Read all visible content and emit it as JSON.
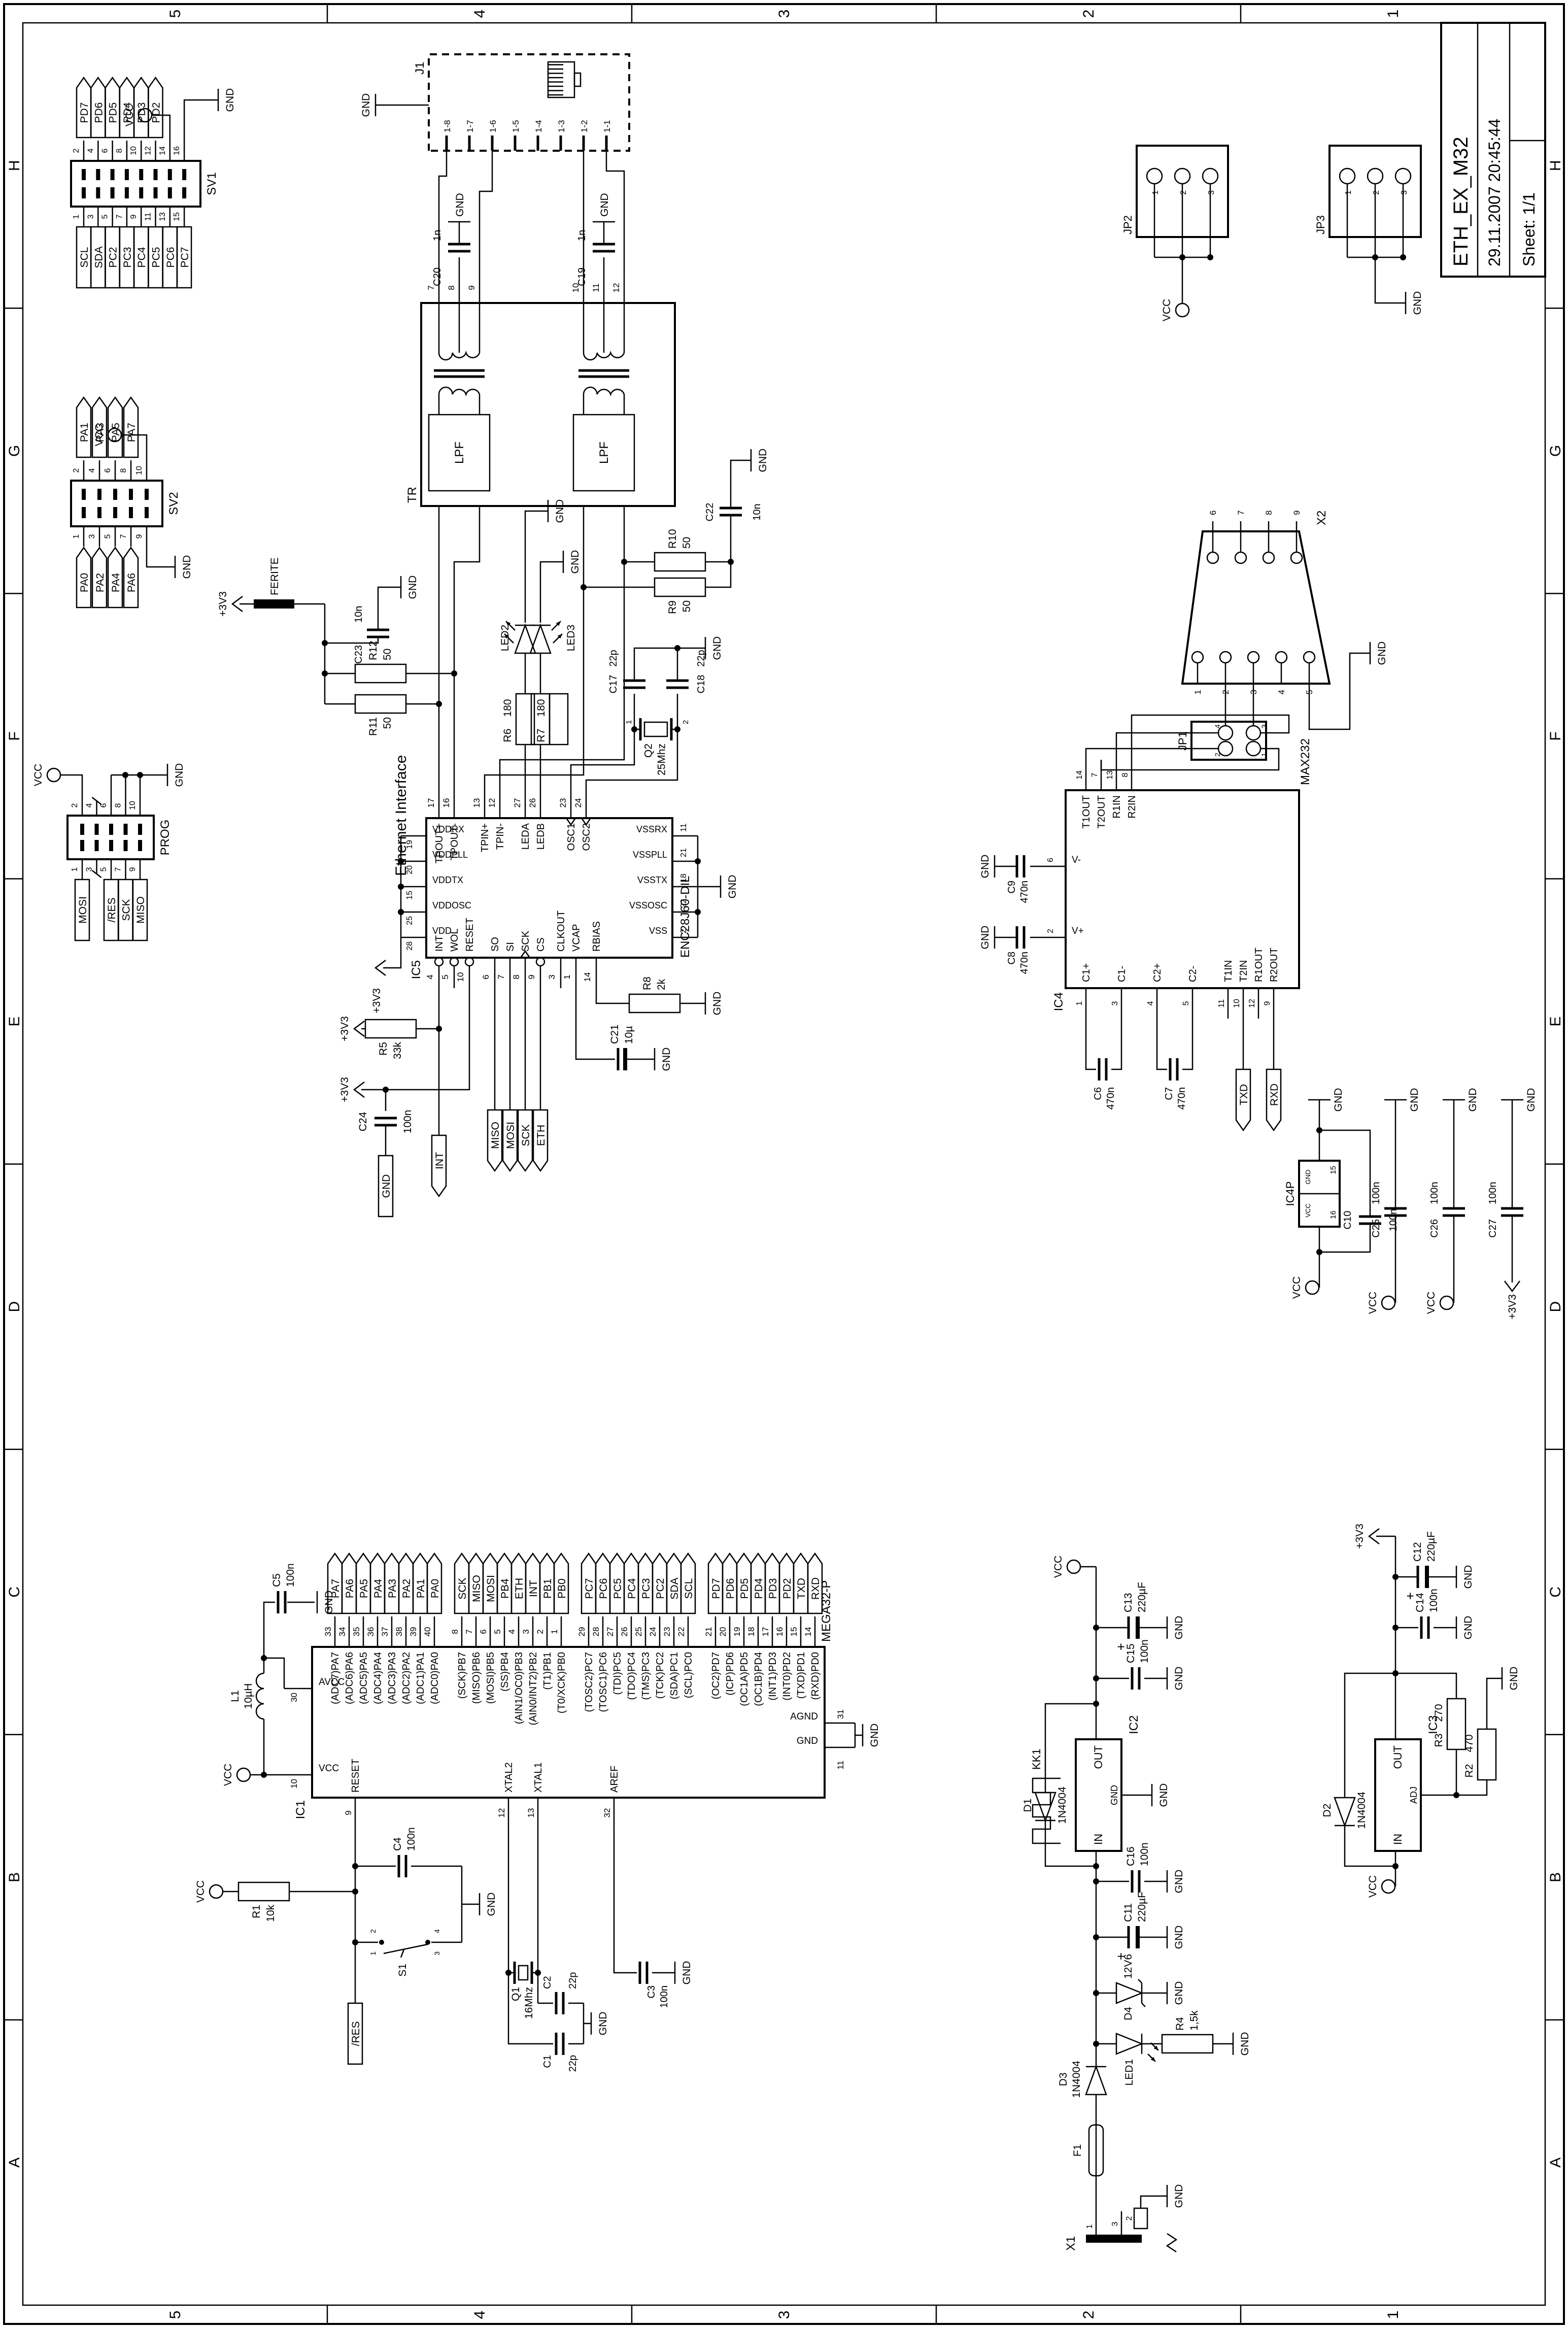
{
  "frame": {
    "columns": [
      "A",
      "B",
      "C",
      "D",
      "E",
      "F",
      "G",
      "H"
    ],
    "rows": [
      "5",
      "4",
      "3",
      "2",
      "1"
    ]
  },
  "title_block": {
    "title": "ETH_EX_M32",
    "datetime": "29.11.2007 20:45:44",
    "sheet": "Sheet: 1/1"
  },
  "sections": {
    "ethernet": "Ethernet Interface"
  },
  "nets": {
    "vcc": "VCC",
    "gnd": "GND",
    "p3v3": "+3V3"
  },
  "flags": {
    "res": "/RES",
    "int": "INT",
    "miso": "MISO",
    "mosi": "MOSI",
    "sck": "SCK",
    "eth": "ETH",
    "txd": "TXD",
    "rxd": "RXD",
    "gnd": "GND"
  },
  "parts": {
    "R1": "10k",
    "R2": "470",
    "R3": "270",
    "R4": "1,5k",
    "R5": "33k",
    "R6": "180",
    "R7": "180",
    "R8": "2k",
    "R9": "50",
    "R10": "50",
    "R11": "50",
    "R12": "50",
    "C1": "22p",
    "C2": "22p",
    "C3": "100n",
    "C4": "100n",
    "C5": "100n",
    "C6": "470n",
    "C7": "470n",
    "C8": "470n",
    "C9": "470n",
    "C10": "100n",
    "C11": "220µF",
    "C12": "220µF",
    "C13": "220µF",
    "C14": "100n",
    "C15": "100n",
    "C16": "100n",
    "C17": "22p",
    "C18": "22p",
    "C19": "1n",
    "C20": "1n",
    "C21": "10µ",
    "C22": "10n",
    "C23": "10n",
    "C24": "100n",
    "C25": "100n",
    "C26": "100n",
    "C27": "100n",
    "L1": "10µH",
    "Q1": "16Mhz",
    "Q2": "25Mhz",
    "D1": "1N4004",
    "D2": "1N4004",
    "D3": "1N4004",
    "D4": "12V6",
    "LED1": "",
    "LED2": "",
    "LED3": "",
    "S1": "",
    "F1": "",
    "X1": "",
    "KK1": "",
    "FERITE": "",
    "TR": ""
  },
  "ic1": {
    "ref": "IC1",
    "part": "MEGA32-P",
    "top": [
      {
        "num": "10",
        "name": "VCC"
      },
      {
        "num": "30",
        "name": "AVCC"
      }
    ],
    "left": [
      {
        "num": "9",
        "name": "RESET"
      },
      {
        "num": "12",
        "name": "XTAL2"
      },
      {
        "num": "13",
        "name": "XTAL1"
      },
      {
        "num": "32",
        "name": "AREF"
      }
    ],
    "bottom": [
      {
        "num": "31",
        "name": "AGND"
      },
      {
        "num": "11",
        "name": "GND"
      }
    ],
    "right_groups": [
      [
        {
          "num": "33",
          "name": "(ADC7)PA7",
          "flag": "PA7"
        },
        {
          "num": "34",
          "name": "(ADC6)PA6",
          "flag": "PA6"
        },
        {
          "num": "35",
          "name": "(ADC5)PA5",
          "flag": "PA5"
        },
        {
          "num": "36",
          "name": "(ADC4)PA4",
          "flag": "PA4"
        },
        {
          "num": "37",
          "name": "(ADC3)PA3",
          "flag": "PA3"
        },
        {
          "num": "38",
          "name": "(ADC2)PA2",
          "flag": "PA2"
        },
        {
          "num": "39",
          "name": "(ADC1)PA1",
          "flag": "PA1"
        },
        {
          "num": "40",
          "name": "(ADC0)PA0",
          "flag": "PA0"
        }
      ],
      [
        {
          "num": "8",
          "name": "(SCK)PB7",
          "flag": "SCK"
        },
        {
          "num": "7",
          "name": "(MISO)PB6",
          "flag": "MISO"
        },
        {
          "num": "6",
          "name": "(MOSI)PB5",
          "flag": "MOSI"
        },
        {
          "num": "5",
          "name": "(SS)PB4",
          "flag": "PB4"
        },
        {
          "num": "4",
          "name": "(AIN1/OC0)PB3",
          "flag": "ETH"
        },
        {
          "num": "3",
          "name": "(AIN0/INT2)PB2",
          "flag": "INT"
        },
        {
          "num": "2",
          "name": "(T1)PB1",
          "flag": "PB1"
        },
        {
          "num": "1",
          "name": "(T0/XCK)PB0",
          "flag": "PB0"
        }
      ],
      [
        {
          "num": "29",
          "name": "(TOSC2)PC7",
          "flag": "PC7"
        },
        {
          "num": "28",
          "name": "(TOSC1)PC6",
          "flag": "PC6"
        },
        {
          "num": "27",
          "name": "(TDI)PC5",
          "flag": "PC5"
        },
        {
          "num": "26",
          "name": "(TDO)PC4",
          "flag": "PC4"
        },
        {
          "num": "25",
          "name": "(TMS)PC3",
          "flag": "PC3"
        },
        {
          "num": "24",
          "name": "(TCK)PC2",
          "flag": "PC2"
        },
        {
          "num": "23",
          "name": "(SDA)PC1",
          "flag": "SDA"
        },
        {
          "num": "22",
          "name": "(SCL)PC0",
          "flag": "SCL"
        }
      ],
      [
        {
          "num": "21",
          "name": "(OC2)PD7",
          "flag": "PD7"
        },
        {
          "num": "20",
          "name": "(ICP)PD6",
          "flag": "PD6"
        },
        {
          "num": "19",
          "name": "(OC1A)PD5",
          "flag": "PD5"
        },
        {
          "num": "18",
          "name": "(OC1B)PD4",
          "flag": "PD4"
        },
        {
          "num": "17",
          "name": "(INT1)PD3",
          "flag": "PD3"
        },
        {
          "num": "16",
          "name": "(INT0)PD2",
          "flag": "PD2"
        },
        {
          "num": "15",
          "name": "(TXD)PD1",
          "flag": "TXD"
        },
        {
          "num": "14",
          "name": "(RXD)PD0",
          "flag": "RXD"
        }
      ]
    ]
  },
  "ic5": {
    "ref": "IC5",
    "part": "ENC28J60-DIL",
    "left": [
      {
        "num": "4",
        "name": "INT",
        "inv": 1
      },
      {
        "num": "5",
        "name": "WOL",
        "inv": 1
      },
      {
        "num": "10",
        "name": "RESET",
        "inv": 1
      },
      {
        "num": "6",
        "name": "SO"
      },
      {
        "num": "7",
        "name": "SI"
      },
      {
        "num": "8",
        "name": "SCK",
        "clk": 1
      },
      {
        "num": "9",
        "name": "CS",
        "inv": 1
      },
      {
        "num": "3",
        "name": "CLKOUT"
      },
      {
        "num": "1",
        "name": "VCAP"
      },
      {
        "num": "14",
        "name": "RBIAS"
      }
    ],
    "top": [
      {
        "num": "28",
        "name": "VDD"
      },
      {
        "num": "25",
        "name": "VDDOSC"
      },
      {
        "num": "15",
        "name": "VDDTX"
      },
      {
        "num": "20",
        "name": "VDDPLL"
      },
      {
        "num": "19",
        "name": "VDDRX"
      }
    ],
    "bottom": [
      {
        "num": "2",
        "name": "VSS"
      },
      {
        "num": "22",
        "name": "VSSOSC"
      },
      {
        "num": "18",
        "name": "VSSTX"
      },
      {
        "num": "21",
        "name": "VSSPLL"
      },
      {
        "num": "11",
        "name": "VSSRX"
      }
    ],
    "right": [
      {
        "num": "17",
        "name": "TPOUT+"
      },
      {
        "num": "16",
        "name": "TPOUT-"
      },
      {
        "num": "13",
        "name": "TPIN+"
      },
      {
        "num": "12",
        "name": "TPIN-"
      },
      {
        "num": "27",
        "name": "LEDA"
      },
      {
        "num": "26",
        "name": "LEDB"
      },
      {
        "num": "23",
        "name": "OSC1",
        "clk": 1
      },
      {
        "num": "24",
        "name": "OSC2",
        "clk": 1
      }
    ]
  },
  "ic4": {
    "ref": "IC4",
    "part": "MAX232",
    "left": [
      {
        "num": "1",
        "name": "C1+"
      },
      {
        "num": "3",
        "name": "C1-"
      },
      {
        "num": "4",
        "name": "C2+"
      },
      {
        "num": "5",
        "name": "C2-"
      },
      {
        "num": "11",
        "name": "T1IN"
      },
      {
        "num": "10",
        "name": "T2IN"
      },
      {
        "num": "12",
        "name": "R1OUT"
      },
      {
        "num": "9",
        "name": "R2OUT"
      }
    ],
    "top": [
      {
        "num": "2",
        "name": "V+"
      },
      {
        "num": "6",
        "name": "V-"
      }
    ],
    "right": [
      {
        "num": "14",
        "name": "T1OUT"
      },
      {
        "num": "7",
        "name": "T2OUT"
      },
      {
        "num": "13",
        "name": "R1IN"
      },
      {
        "num": "8",
        "name": "R2IN"
      }
    ]
  },
  "ic4p": {
    "ref": "IC4P",
    "vcc_num": "16",
    "gnd_num": "15",
    "vcc": "VCC",
    "gnd": "GND"
  },
  "ic2": {
    "ref": "IC2",
    "in": "IN",
    "out": "OUT",
    "gnd": "GND"
  },
  "ic3": {
    "ref": "IC3",
    "in": "IN",
    "out": "OUT",
    "adj": "ADJ"
  },
  "sv1": {
    "ref": "SV1",
    "right": [
      {
        "num": "2",
        "flag": "PD7"
      },
      {
        "num": "4",
        "flag": "PD6"
      },
      {
        "num": "6",
        "flag": "PD5"
      },
      {
        "num": "8",
        "flag": "PD4"
      },
      {
        "num": "10",
        "flag": "PD3"
      },
      {
        "num": "12",
        "flag": "PD2"
      },
      {
        "num": "14",
        "net": "VCC"
      },
      {
        "num": "16",
        "net": "GND"
      }
    ],
    "left": [
      {
        "num": "1",
        "flag": "SCL"
      },
      {
        "num": "3",
        "flag": "SDA"
      },
      {
        "num": "5",
        "flag": "PC2"
      },
      {
        "num": "7",
        "flag": "PC3"
      },
      {
        "num": "9",
        "flag": "PC4"
      },
      {
        "num": "11",
        "flag": "PC5"
      },
      {
        "num": "13",
        "flag": "PC6"
      },
      {
        "num": "15",
        "flag": "PC7"
      }
    ]
  },
  "sv2": {
    "ref": "SV2",
    "right": [
      {
        "num": "2",
        "flag": "PA1"
      },
      {
        "num": "4",
        "flag": "PA3"
      },
      {
        "num": "6",
        "flag": "PA5"
      },
      {
        "num": "8",
        "flag": "PA7"
      },
      {
        "num": "10",
        "net": "VCC"
      }
    ],
    "left": [
      {
        "num": "1",
        "flag": "PA0"
      },
      {
        "num": "3",
        "flag": "PA2"
      },
      {
        "num": "5",
        "flag": "PA4"
      },
      {
        "num": "7",
        "flag": "PA6"
      },
      {
        "num": "9",
        "net": "GND"
      }
    ]
  },
  "prog": {
    "ref": "PROG",
    "right": [
      {
        "num": "2",
        "net": "VCC"
      },
      {
        "num": "4"
      },
      {
        "num": "6",
        "net": "GND"
      },
      {
        "num": "8",
        "net": "GND"
      },
      {
        "num": "10",
        "net": "GND"
      }
    ],
    "left": [
      {
        "num": "1",
        "flag": "MOSI"
      },
      {
        "num": "3"
      },
      {
        "num": "5",
        "flag": "/RES"
      },
      {
        "num": "7",
        "flag": "SCK"
      },
      {
        "num": "9",
        "flag": "MISO"
      }
    ]
  },
  "x2": {
    "ref": "X2",
    "left": [
      "1",
      "2",
      "3",
      "4",
      "5"
    ],
    "right": [
      "6",
      "7",
      "8",
      "9"
    ]
  },
  "jp1": {
    "ref": "JP1",
    "pins": [
      "1",
      "2",
      "3",
      "4"
    ]
  },
  "jp2": {
    "ref": "JP2",
    "pins": [
      "1",
      "2",
      "3"
    ]
  },
  "jp3": {
    "ref": "JP3",
    "pins": [
      "1",
      "2",
      "3"
    ]
  },
  "j1": {
    "ref": "J1",
    "pins": [
      "1-8",
      "1-7",
      "1-6",
      "1-5",
      "1-4",
      "1-3",
      "1-2",
      "1-1"
    ]
  },
  "x1": {
    "ref": "X1",
    "pins": [
      "1",
      "3",
      "2"
    ]
  },
  "tr": {
    "ref": "TR",
    "lpf": "LPF",
    "pins": [
      "7",
      "8",
      "9",
      "10",
      "11",
      "12"
    ]
  },
  "s1_pins": [
    "1",
    "2",
    "3",
    "4"
  ],
  "q2_pins": [
    "1",
    "2"
  ]
}
